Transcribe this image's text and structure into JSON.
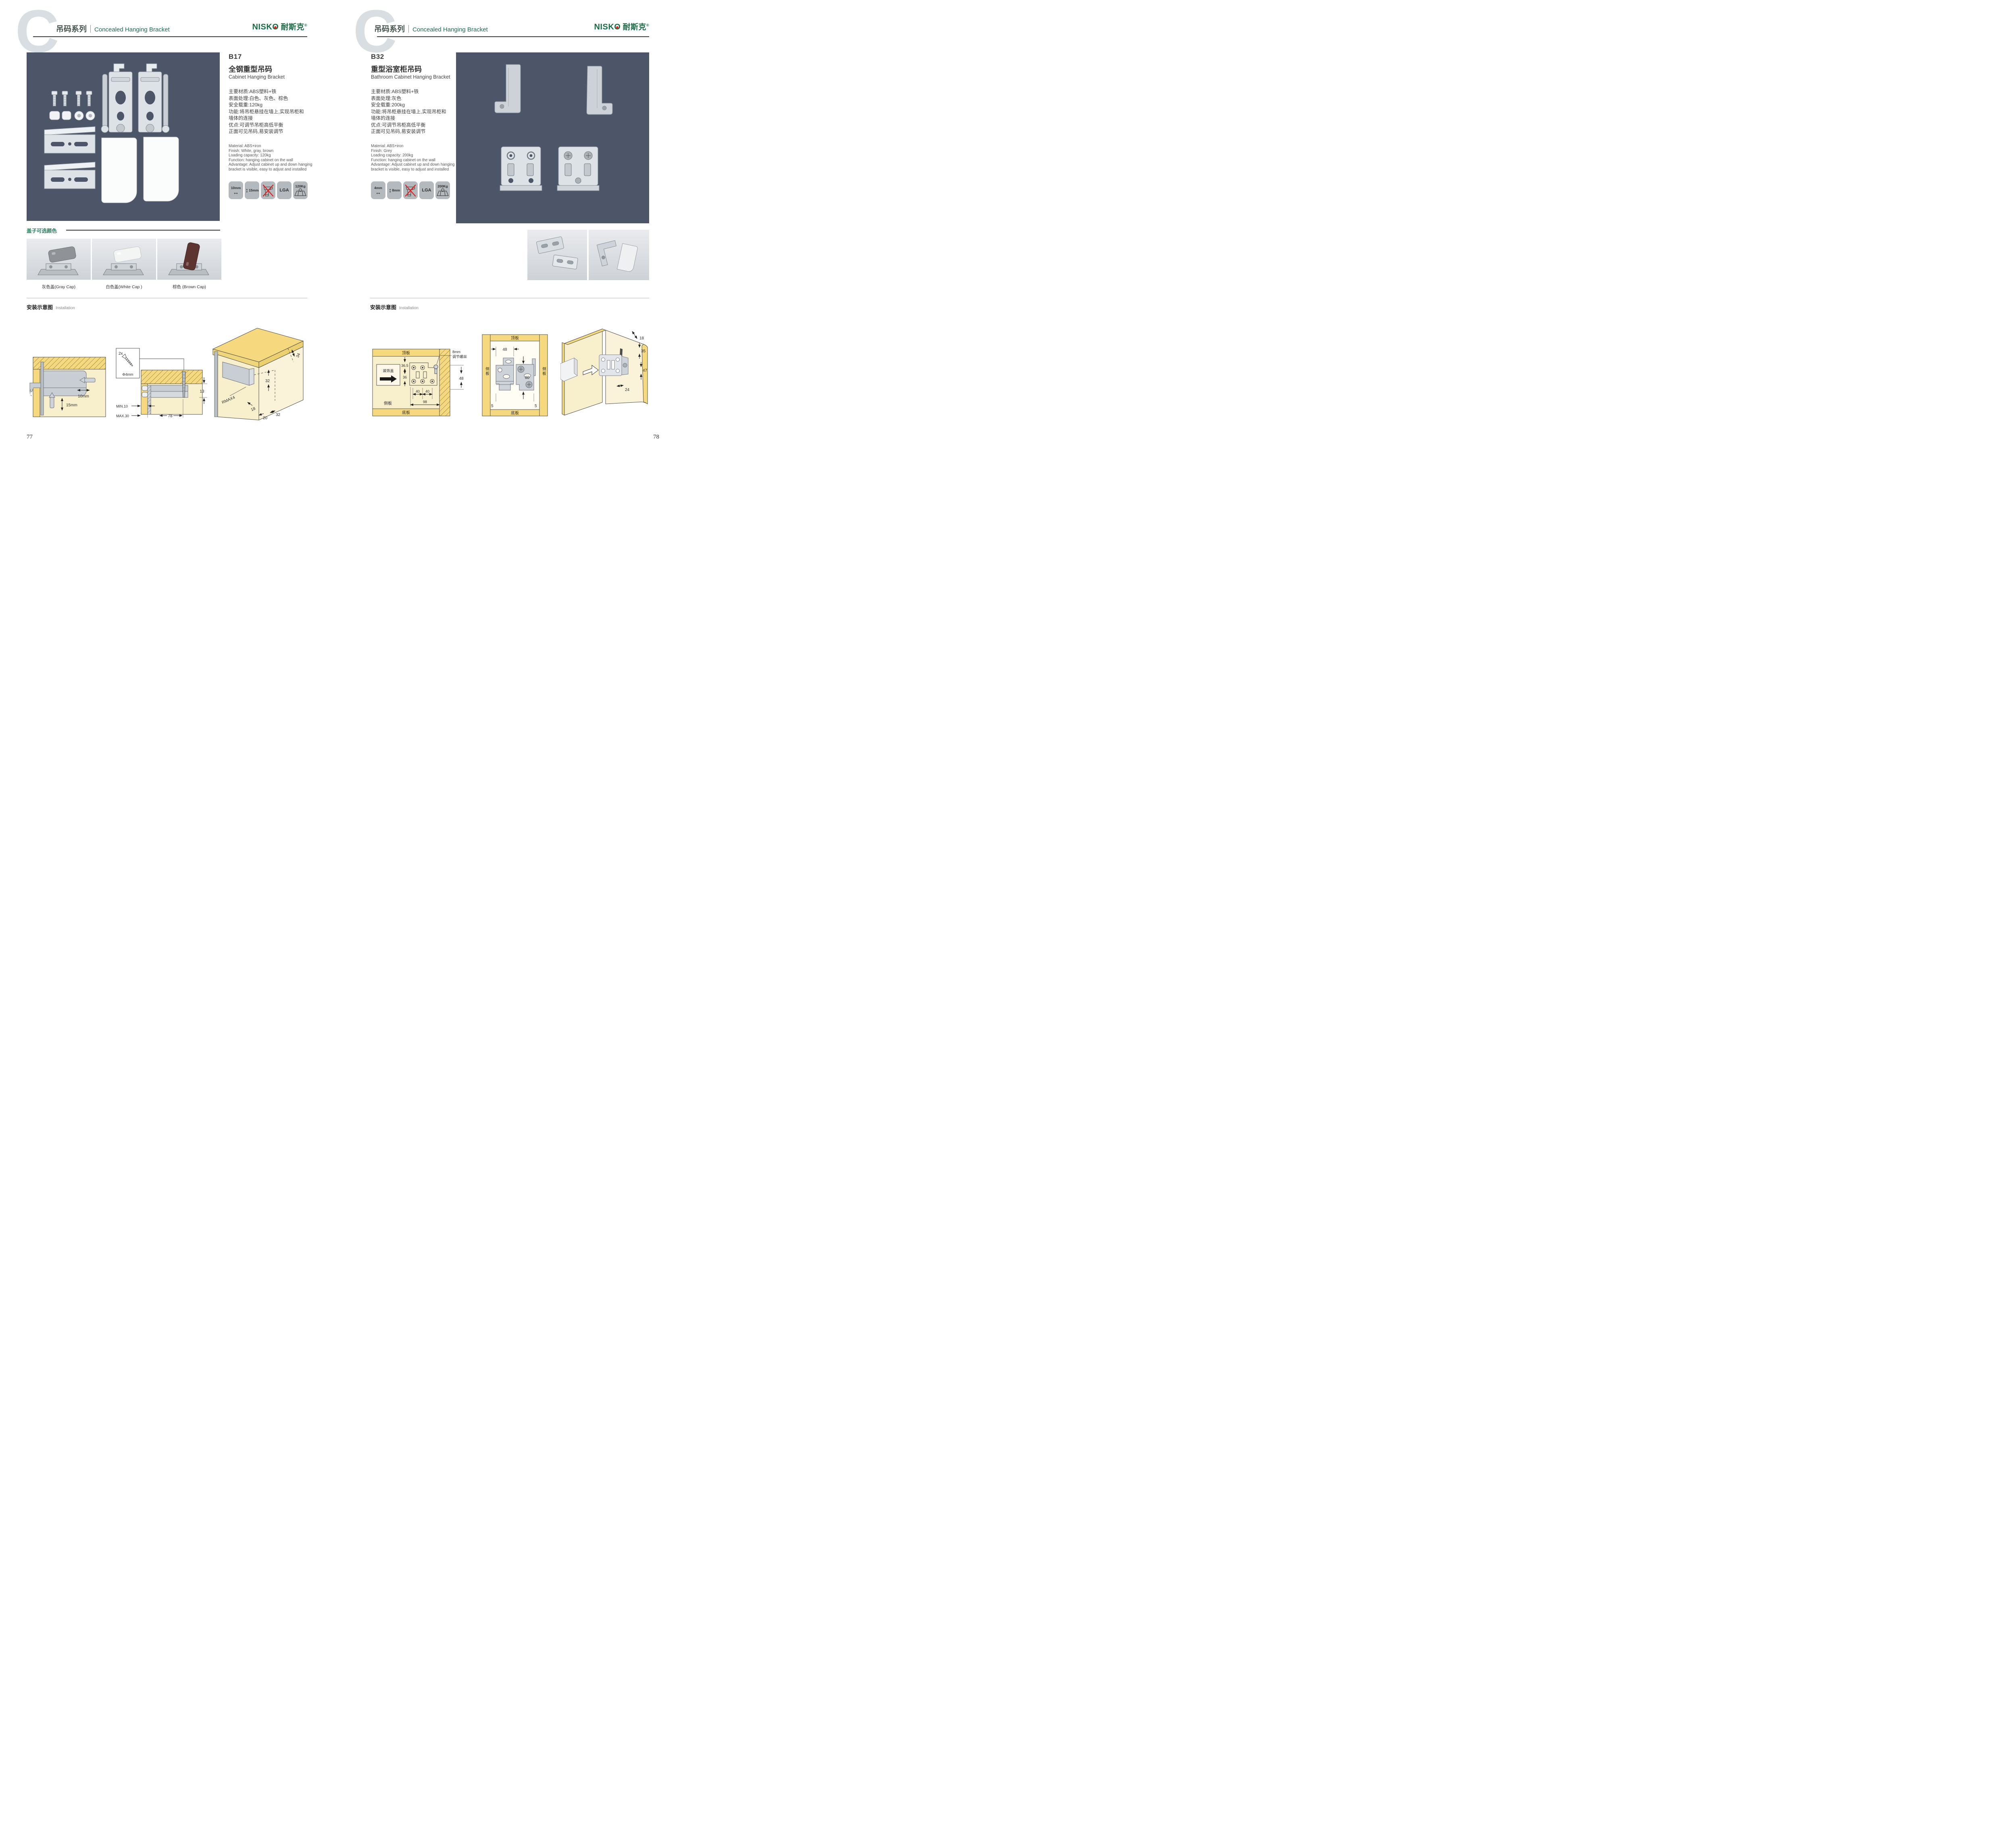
{
  "brand": {
    "logo_en": "NISK",
    "logo_o": "O",
    "logo_cn": "耐斯克",
    "reg": "®",
    "green": "#1a6b47",
    "red": "#d8251c"
  },
  "header": {
    "watermark": "C",
    "series_cn": "吊码系列",
    "series_en": "Concealed Hanging Bracket"
  },
  "left": {
    "page_number": "77",
    "product": {
      "code": "B17",
      "title_cn": "全钢重型吊码",
      "title_en": "Cabinet Hanging Bracket",
      "specs_cn": [
        "主要材质:ABS塑料+铁",
        "表面处理:白色、灰色、棕色",
        "安全载重:120kg",
        "功能:将吊柜悬挂在墙上,实现吊柜和",
        "墙体的连接",
        "优点:可调节吊柜高低平衡",
        "正面可见吊码,易安装调节"
      ],
      "specs_en": [
        "Material: ABS+iron",
        "Finish: White, gray, brown",
        "Loading capacity: 120kg",
        "Function: hanging cabinet on the wall",
        "Advantage: Adjust cabinet up and down hanging",
        "bracket is visible, easy to adjust and installed"
      ],
      "icons": {
        "width": "10mm",
        "height": "15mm",
        "cert": "LGA",
        "load": "120Kg"
      }
    },
    "caps": {
      "title": "盖子可选颜色",
      "labels": [
        "灰色盖(Gray Cap)",
        "白色盖(White Cap )",
        "棕色 (Brown Cap)"
      ],
      "colors": [
        "#8f9397",
        "#f3f4f4",
        "#5e3431"
      ]
    },
    "install": {
      "title_cn": "安装示意图",
      "title_en": "Installation",
      "d1": {
        "h": "10mm",
        "v": "15mm"
      },
      "d2": {
        "qty": "2x",
        "dia": "Φ4mm",
        "t": "13",
        "min": "MIN.10",
        "max": "MAX.30",
        "w": "78"
      },
      "d3": {
        "a": "34",
        "b": "32",
        "r": "RMAX4",
        "c": "18",
        "d": "20",
        "e": "32"
      }
    }
  },
  "right": {
    "page_number": "78",
    "product": {
      "code": "B32",
      "title_cn": "重型浴室柜吊码",
      "title_en": "Bathroom Cabinet Hanging Bracket",
      "specs_cn": [
        "主要材质:ABS塑料+铁",
        "表面处理:灰色",
        "安全载重:200kg",
        "功能:将吊柜悬挂在墙上,实现吊柜和",
        "墙体的连接",
        "优点:可调节吊柜高低平衡",
        "正面可见吊码,易安装调节"
      ],
      "specs_en": [
        "Material: ABS+iron",
        "Finish: Grey",
        "Loading capacity: 200kg",
        "Function: hanging cabinet on the wall",
        "Advantage: Adjust cabinet up and down hanging",
        "bracket is visible, easy to adjust and installed"
      ],
      "icons": {
        "width": "4mm",
        "height": "8mm",
        "cert": "LGA",
        "load": "200Kg"
      }
    },
    "install": {
      "title_cn": "安装示意图",
      "title_en": "Installation",
      "d1": {
        "top": "顶板",
        "bottom": "底板",
        "side": "侧板",
        "cover": "装饰盖",
        "g1": "36.5",
        "g2": "36",
        "s1": "40",
        "s2": "40",
        "w": "98",
        "screw1": "8mm",
        "screw2": "调节螺丝",
        "h": "48"
      },
      "d2": {
        "top": "顶板",
        "bottom": "底板",
        "side": "侧板",
        "w": "48",
        "h": "80",
        "m1": "5",
        "m2": "5"
      },
      "d3": {
        "a": "18",
        "b": "35",
        "c": "47",
        "d": "24"
      }
    }
  }
}
